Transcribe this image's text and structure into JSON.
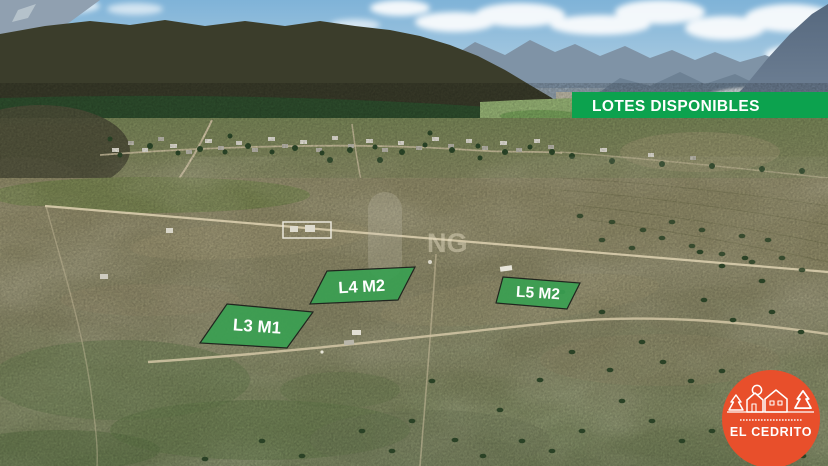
{
  "banner": {
    "label": "LOTES DISPONIBLES"
  },
  "lots": [
    {
      "id": "L3-M1",
      "label": "L3 M1"
    },
    {
      "id": "L4-M2",
      "label": "L4 M2"
    },
    {
      "id": "L5-M2",
      "label": "L5 M2"
    }
  ],
  "logo": {
    "title": "EL CEDRITO"
  },
  "watermark": {
    "text": "NG"
  },
  "colors": {
    "banner_green": "#0ca24e",
    "lot_green": "#3aa051",
    "logo_orange": "#e84f2b",
    "text_white": "#ffffff"
  }
}
